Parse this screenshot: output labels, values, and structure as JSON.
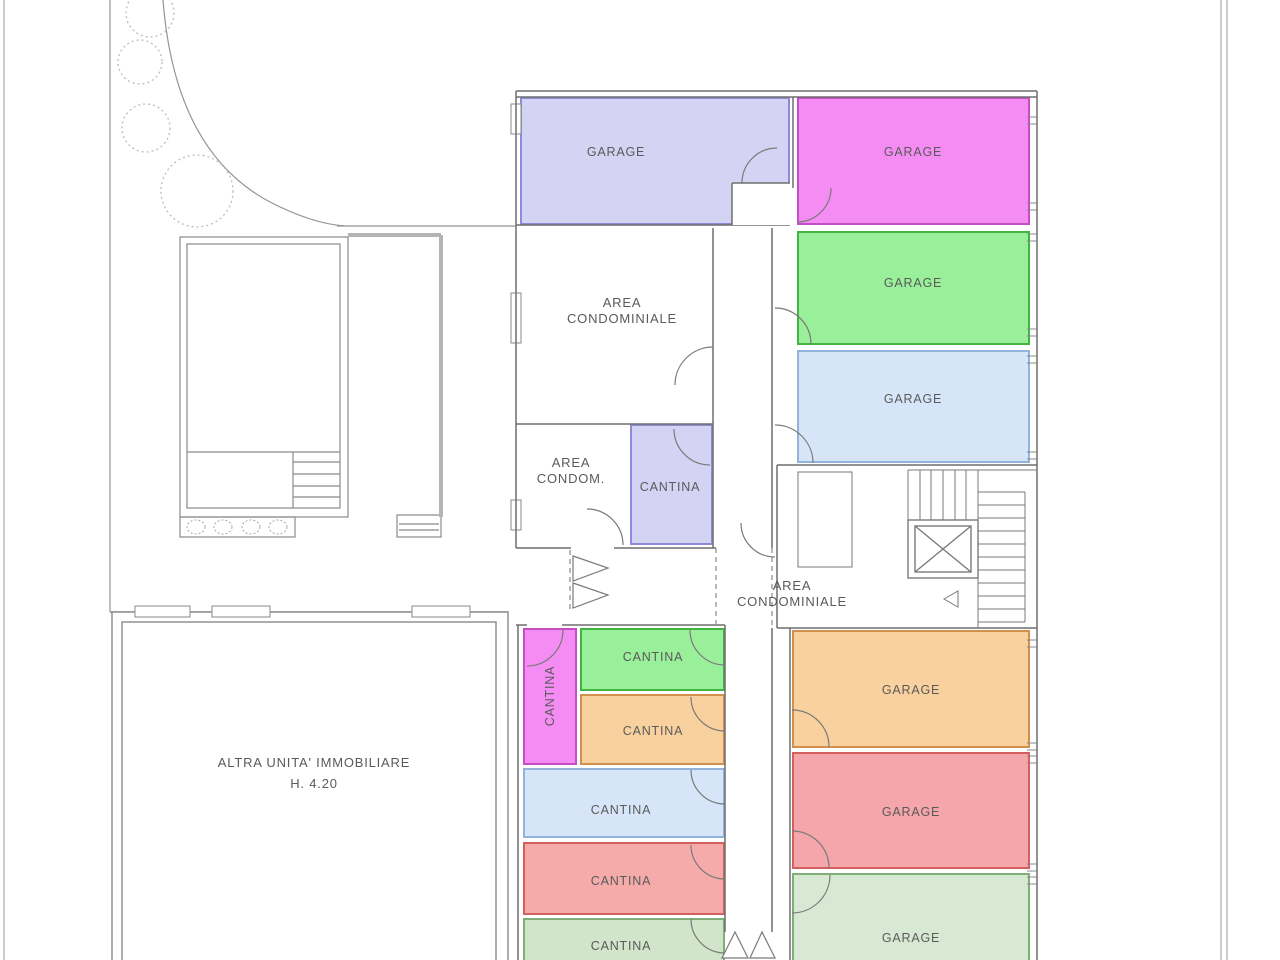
{
  "floor_plan": {
    "type": "basement-garage-cellar plan",
    "colors": {
      "lavender": "#d4d3f3",
      "magenta": "#f48cf4",
      "green": "#9aef9a",
      "light_blue": "#d6e6f8",
      "orange": "#f9d19e",
      "salmon": "#f6abab",
      "pale_green_cantina": "#d0e5c9",
      "pale_green_garage": "#d8e9d3",
      "wall": "#6f6f6f",
      "label_text": "#5a5a5a"
    },
    "rooms": [
      {
        "id": "garage-nw",
        "label": "GARAGE",
        "color": "#d4d3f3"
      },
      {
        "id": "garage-ne",
        "label": "GARAGE",
        "color": "#f48cf4"
      },
      {
        "id": "garage-e-green",
        "label": "GARAGE",
        "color": "#9aef9a"
      },
      {
        "id": "garage-e-blue",
        "label": "GARAGE",
        "color": "#d6e6f8"
      },
      {
        "id": "cantina-lavender",
        "label": "CANTINA",
        "color": "#d4d3f3"
      },
      {
        "id": "cantina-magenta",
        "label": "CANTINA",
        "color": "#f48cf4"
      },
      {
        "id": "cantina-green",
        "label": "CANTINA",
        "color": "#9aef9a"
      },
      {
        "id": "cantina-orange",
        "label": "CANTINA",
        "color": "#f9d19e"
      },
      {
        "id": "cantina-blue",
        "label": "CANTINA",
        "color": "#d6e6f8"
      },
      {
        "id": "cantina-red",
        "label": "CANTINA",
        "color": "#f6abab"
      },
      {
        "id": "cantina-pale-green",
        "label": "CANTINA",
        "color": "#d0e5c9"
      },
      {
        "id": "garage-s-orange",
        "label": "GARAGE",
        "color": "#f9d19e"
      },
      {
        "id": "garage-s-red",
        "label": "GARAGE",
        "color": "#f5a6aa"
      },
      {
        "id": "garage-s-green",
        "label": "GARAGE",
        "color": "#d8e9d3"
      }
    ],
    "areas": {
      "area_condominiale_upper": {
        "line1": "AREA",
        "line2": "CONDOMINIALE"
      },
      "area_condom_small": {
        "line1": "AREA",
        "line2": "CONDOM."
      },
      "area_condominiale_open": {
        "line1": "AREA",
        "line2": "CONDOMINIALE"
      },
      "altra_unita": {
        "line1": "ALTRA UNITA' IMMOBILIARE",
        "line2": "H. 4.20"
      }
    }
  }
}
